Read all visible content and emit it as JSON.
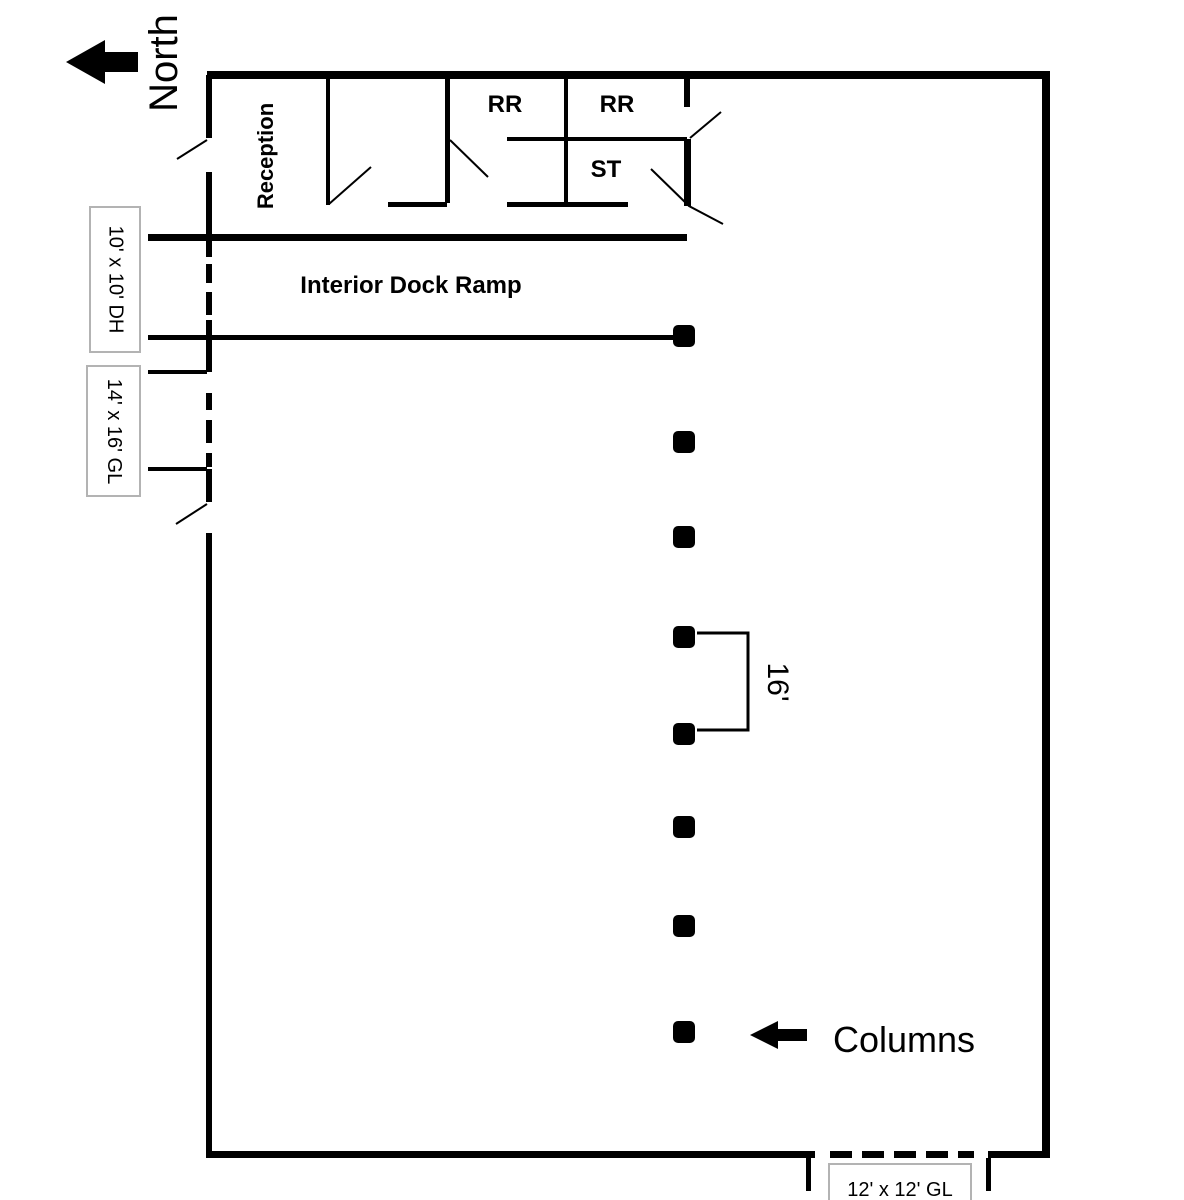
{
  "compass": {
    "label": "North"
  },
  "rooms": [
    {
      "id": "reception",
      "label": "Reception"
    },
    {
      "id": "restroom-1",
      "label": "RR"
    },
    {
      "id": "restroom-2",
      "label": "RR"
    },
    {
      "id": "storage",
      "label": "ST"
    }
  ],
  "areas": {
    "interior_dock_ramp": "Interior Dock Ramp"
  },
  "door_labels": {
    "dock_high_west": "10' x 10' DH",
    "grade_level_west": "14' x 16' GL",
    "grade_level_south": "12' x 12' GL"
  },
  "columns": {
    "count": 8,
    "annotation": "Columns",
    "spacing_dimension": "16'"
  },
  "colors": {
    "line": "#000000",
    "background": "#ffffff",
    "label_box_border": "#b3b3b3"
  }
}
